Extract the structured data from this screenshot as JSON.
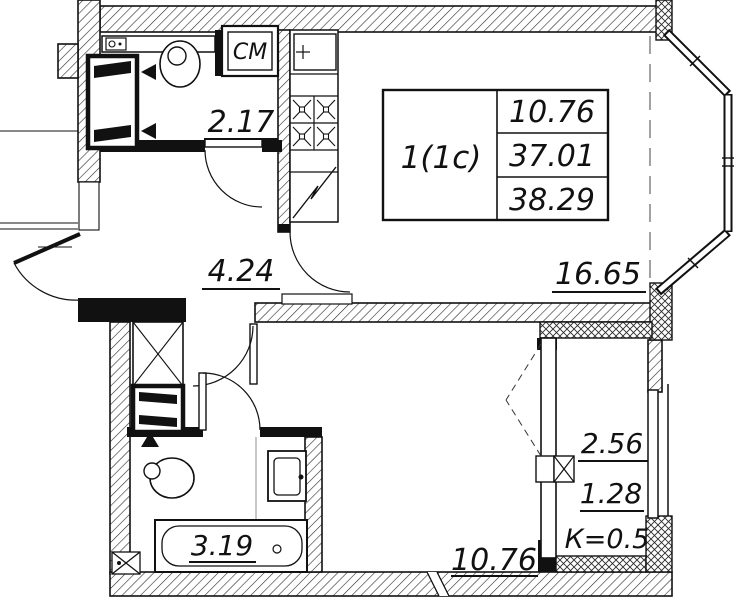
{
  "plan": {
    "table": {
      "type": "1(1с)",
      "values": [
        "10.76",
        "37.01",
        "38.29"
      ]
    },
    "rooms": {
      "wc": "2.17",
      "hallway": "4.24",
      "living": "16.65",
      "bathroom": "3.19",
      "bedroom": "10.76"
    },
    "loggia": {
      "area": "2.56",
      "reduced": "1.28",
      "coefficient": "К=0.5"
    },
    "appliances": {
      "washing_machine": "СМ"
    },
    "colors": {
      "line": "#111111",
      "background": "#ffffff"
    }
  }
}
